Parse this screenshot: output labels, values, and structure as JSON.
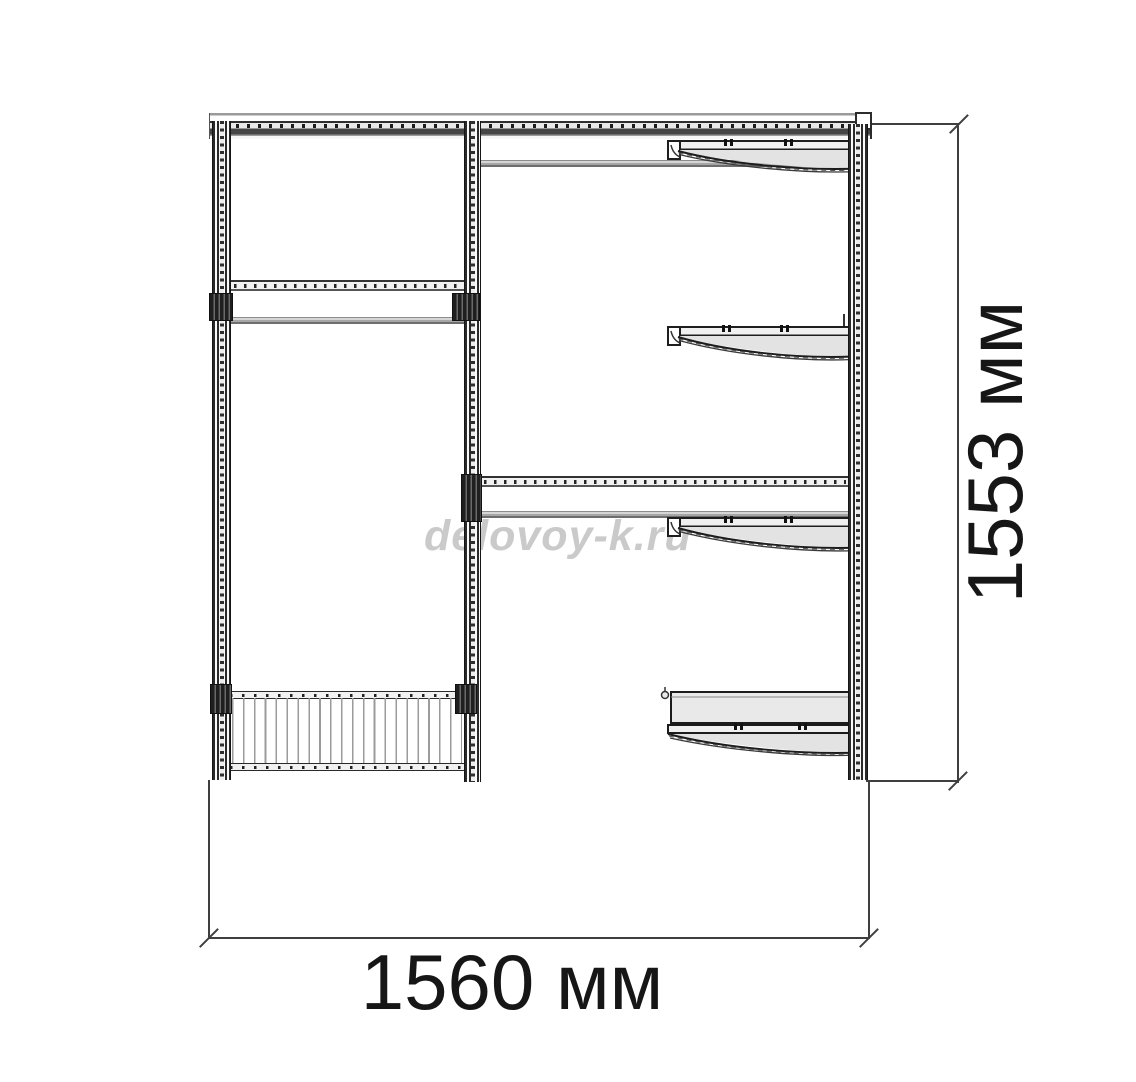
{
  "drawing": {
    "type": "wardrobe-front-elevation",
    "watermark": "delovoy-k.ru",
    "dimensions": {
      "width": {
        "label": "1560 мм",
        "value_mm": 1560
      },
      "height": {
        "label": "1553 мм",
        "value_mm": 1553
      }
    },
    "colors": {
      "background": "#ffffff",
      "line": "#2c2c2c",
      "dimension_line": "#3f3f3f",
      "label_text": "#161616",
      "watermark": "#cacaca",
      "rail_fill": "#ececec",
      "shelf_fill": "#e3e3e3",
      "rod_light": "#d6d6d6"
    },
    "parts": {
      "posts": [
        "left-post",
        "center-post",
        "right-post"
      ],
      "left_bay": [
        "top-rail",
        "hanging-rail",
        "clothes-rod",
        "wire-basket"
      ],
      "right_bay": [
        "clothes-rod",
        "shelf-1",
        "shelf-2",
        "hanging-rail",
        "clothes-rod",
        "shelf-3",
        "deep-shelf-4"
      ]
    }
  }
}
